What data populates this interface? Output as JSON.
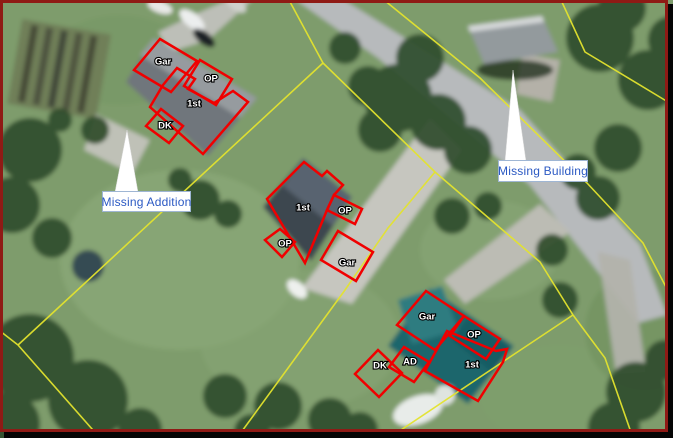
{
  "colors": {
    "sketch_red": "#f00000",
    "parcel_yellow": "#e3e32e",
    "callout_text_blue": "#2b59c3",
    "callout_border": "#9fb6d4",
    "label_white": "#ffffff",
    "label_halo_black": "#000000",
    "frame_maroon": "#8f1a15"
  },
  "callouts": [
    {
      "id": "missing-addition",
      "text": "Missing Addition",
      "box": {
        "x": 102,
        "y": 191,
        "w": 89,
        "h": 21
      },
      "pointer": [
        [
          115,
          192
        ],
        [
          138,
          192
        ],
        [
          127,
          130
        ]
      ]
    },
    {
      "id": "missing-building",
      "text": "Missing Building",
      "box": {
        "x": 498,
        "y": 160,
        "w": 90,
        "h": 22
      },
      "pointer": [
        [
          505,
          161
        ],
        [
          526,
          161
        ],
        [
          513,
          70
        ]
      ]
    }
  ],
  "parcel_lines": [
    {
      "points": [
        [
          289,
          0
        ],
        [
          323,
          63
        ]
      ]
    },
    {
      "points": [
        [
          323,
          63
        ],
        [
          18,
          345
        ]
      ]
    },
    {
      "points": [
        [
          18,
          345
        ],
        [
          0,
          331
        ]
      ]
    },
    {
      "points": [
        [
          18,
          345
        ],
        [
          100,
          438
        ]
      ]
    },
    {
      "points": [
        [
          323,
          63
        ],
        [
          435,
          172
        ],
        [
          540,
          262
        ],
        [
          573,
          315
        ]
      ]
    },
    {
      "points": [
        [
          435,
          172
        ],
        [
          388,
          228
        ],
        [
          345,
          290
        ],
        [
          237,
          438
        ]
      ]
    },
    {
      "points": [
        [
          573,
          315
        ],
        [
          540,
          337
        ],
        [
          510,
          357
        ],
        [
          389,
          438
        ]
      ]
    },
    {
      "points": [
        [
          573,
          315
        ],
        [
          605,
          358
        ],
        [
          633,
          438
        ]
      ]
    },
    {
      "points": [
        [
          561,
          0
        ],
        [
          585,
          52
        ],
        [
          668,
          102
        ]
      ]
    },
    {
      "points": [
        [
          384,
          0
        ],
        [
          480,
          78
        ],
        [
          587,
          183
        ],
        [
          643,
          243
        ],
        [
          666,
          287
        ]
      ]
    }
  ],
  "sketches": [
    {
      "label": "Gar",
      "label_pos": [
        163,
        62
      ],
      "points": [
        [
          160,
          39
        ],
        [
          197,
          61
        ],
        [
          171,
          92
        ],
        [
          134,
          70
        ]
      ]
    },
    {
      "label": "OP",
      "label_pos": [
        211,
        79
      ],
      "points": [
        [
          200,
          60
        ],
        [
          232,
          79
        ],
        [
          216,
          105
        ],
        [
          184,
          86
        ]
      ]
    },
    {
      "label": "1st",
      "label_pos": [
        194,
        104
      ],
      "points": [
        [
          163,
          85
        ],
        [
          177,
          68
        ],
        [
          195,
          79
        ],
        [
          188,
          89
        ],
        [
          214,
          103
        ],
        [
          233,
          91
        ],
        [
          248,
          102
        ],
        [
          203,
          154
        ],
        [
          150,
          107
        ]
      ]
    },
    {
      "label": "DK",
      "label_pos": [
        165,
        126
      ],
      "points": [
        [
          161,
          109
        ],
        [
          183,
          126
        ],
        [
          169,
          143
        ],
        [
          146,
          126
        ]
      ]
    },
    {
      "label": "1st",
      "label_pos": [
        303,
        208
      ],
      "points": [
        [
          304,
          162
        ],
        [
          322,
          176
        ],
        [
          327,
          171
        ],
        [
          343,
          185
        ],
        [
          334,
          195
        ],
        [
          327,
          210
        ],
        [
          305,
          263
        ],
        [
          267,
          199
        ]
      ]
    },
    {
      "label": "OP",
      "label_pos": [
        345,
        211
      ],
      "points": [
        [
          334,
          195
        ],
        [
          362,
          209
        ],
        [
          355,
          224
        ],
        [
          327,
          210
        ]
      ]
    },
    {
      "label": "OP",
      "label_pos": [
        285,
        244
      ],
      "points": [
        [
          280,
          229
        ],
        [
          295,
          242
        ],
        [
          282,
          257
        ],
        [
          265,
          240
        ]
      ]
    },
    {
      "label": "Gar",
      "label_pos": [
        347,
        263
      ],
      "points": [
        [
          338,
          231
        ],
        [
          373,
          252
        ],
        [
          356,
          281
        ],
        [
          321,
          260
        ]
      ]
    },
    {
      "label": "Gar",
      "label_pos": [
        427,
        317
      ],
      "points": [
        [
          426,
          291
        ],
        [
          464,
          316
        ],
        [
          435,
          350
        ],
        [
          397,
          325
        ]
      ]
    },
    {
      "label": "OP",
      "label_pos": [
        474,
        335
      ],
      "points": [
        [
          464,
          316
        ],
        [
          500,
          339
        ],
        [
          486,
          359
        ],
        [
          450,
          336
        ]
      ]
    },
    {
      "label": "1st",
      "label_pos": [
        472,
        365
      ],
      "points": [
        [
          447,
          331
        ],
        [
          496,
          351
        ],
        [
          507,
          349
        ],
        [
          503,
          362
        ],
        [
          478,
          401
        ],
        [
          425,
          371
        ]
      ]
    },
    {
      "label": "AD",
      "label_pos": [
        410,
        362
      ],
      "points": [
        [
          404,
          347
        ],
        [
          429,
          362
        ],
        [
          414,
          382
        ],
        [
          389,
          367
        ]
      ]
    },
    {
      "label": "DK",
      "label_pos": [
        380,
        366
      ],
      "points": [
        [
          378,
          350
        ],
        [
          402,
          373
        ],
        [
          379,
          397
        ],
        [
          355,
          374
        ]
      ]
    }
  ]
}
